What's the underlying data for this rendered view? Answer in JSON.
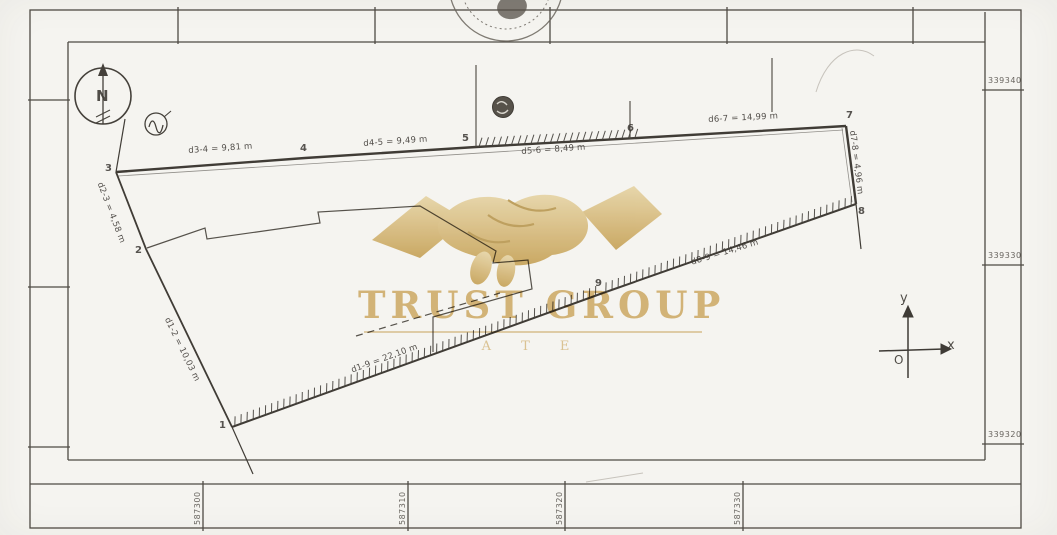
{
  "colors": {
    "paper": "#f5f4f0",
    "ink": "#44403a",
    "watermark_gold": "#d2ab5e"
  },
  "watermark": {
    "brand": "TRUST GROUP",
    "subtitle": "A T E"
  },
  "north": {
    "label": "N"
  },
  "axes": {
    "y_label": "y",
    "x_label": "x",
    "origin_label": "O"
  },
  "grid": {
    "right_labels": [
      "339340",
      "339330",
      "339320"
    ],
    "bottom_labels": [
      "587300",
      "587310",
      "587320",
      "587330"
    ]
  },
  "parcel": {
    "point_labels": [
      "1",
      "2",
      "3",
      "4",
      "5",
      "6",
      "7",
      "8",
      "9"
    ],
    "dimensions": {
      "d3_4": "d3-4 = 9,81 m",
      "d4_5": "d4-5 = 9,49 m",
      "d5_6": "d5-6 = 8,49 m",
      "d6_7": "d6-7 = 14,99 m",
      "d7_8": "d7-8 = 4,96 m",
      "d8_9": "d8-9 = 14,46 m",
      "d1_9": "d1-9 = 22,10 m",
      "d1_2": "d1-2 = 10,03 m",
      "d2_3": "d2-3 = 4,58 m"
    }
  }
}
